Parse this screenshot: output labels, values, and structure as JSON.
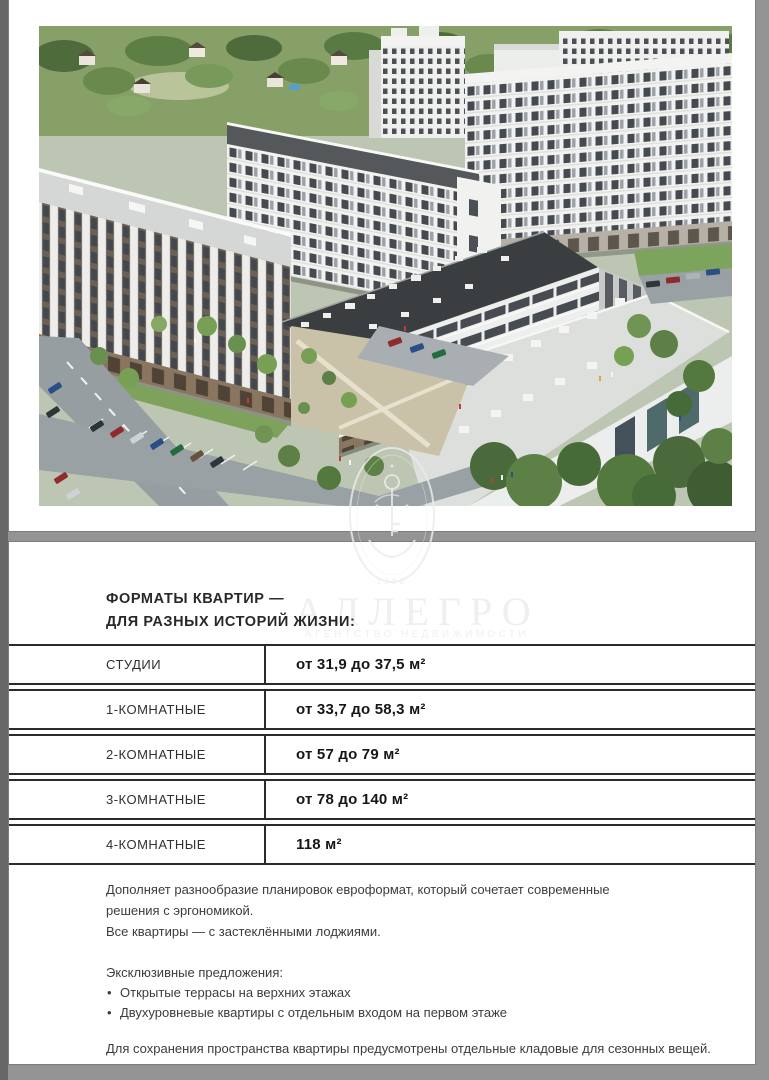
{
  "watermark": {
    "brand": "АЛЛЕГРО",
    "tagline": "АГЕНТСТВО НЕДВИЖИМОСТИ",
    "year": "2008"
  },
  "hero": {
    "image_alt": "aerial-render-of-white-residential-complex-with-courtyard-parking-and-trees",
    "colors": {
      "facade": "#f2f2f0",
      "windows": "#454a50",
      "dark_roof": "#3b3e41",
      "greenery": "#5d8046",
      "road": "#99a0a4"
    }
  },
  "content": {
    "heading_line1": "ФОРМАТЫ КВАРТИР —",
    "heading_line2": "ДЛЯ РАЗНЫХ ИСТОРИЙ ЖИЗНИ:",
    "table": {
      "rows": [
        {
          "label": "СТУДИИ",
          "value": "от 31,9 до 37,5 м²"
        },
        {
          "label": "1-КОМНАТНЫЕ",
          "value": "от 33,7 до 58,3 м²"
        },
        {
          "label": "2-КОМНАТНЫЕ",
          "value": "от 57 до 79 м²"
        },
        {
          "label": "3-КОМНАТНЫЕ",
          "value": "от 78 до 140 м²"
        },
        {
          "label": "4-КОМНАТНЫЕ",
          "value": "118 м²"
        }
      ]
    },
    "paragraph1_line1": "Дополняет разнообразие планировок евроформат, который сочетает современные",
    "paragraph1_line2": "решения с эргономикой.",
    "paragraph1_line3": "Все квартиры — с застеклёнными лоджиями.",
    "offers_title": "Эксклюзивные предложения:",
    "bullet_char": "•",
    "offers": [
      "Открытые террасы на верхних этажах",
      "Двухуровневые квартиры с отдельным входом на первом этаже"
    ],
    "closing": "Для сохранения пространства квартиры предусмотрены отдельные кладовые для сезонных вещей."
  },
  "colors": {
    "page_background": "#8e8e8e",
    "panel": "#ffffff",
    "table_line": "#2b2b2b",
    "body_text": "#3c3c3c",
    "watermark": "#ececea"
  }
}
